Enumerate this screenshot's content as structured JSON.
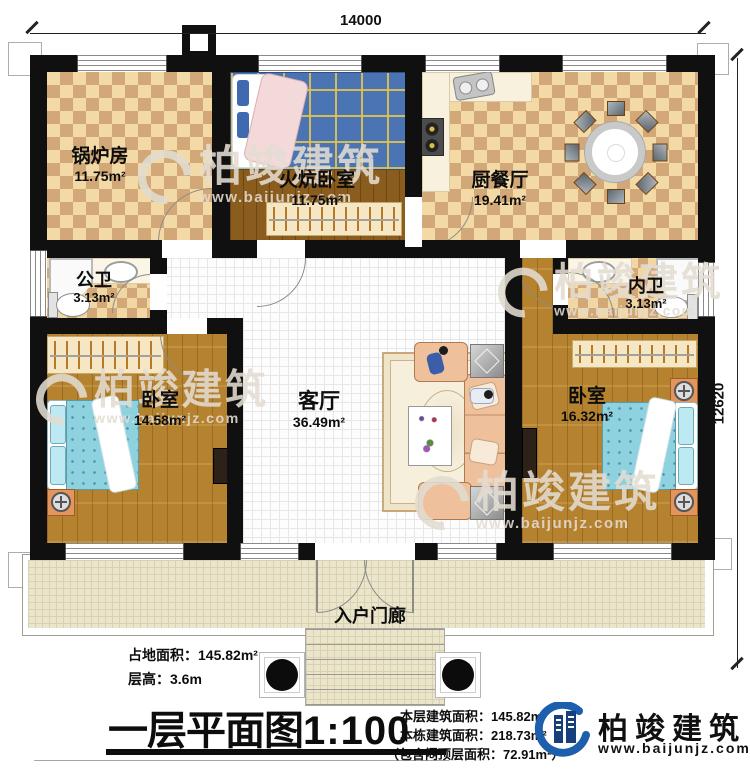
{
  "dimensions": {
    "width": "14000",
    "height": "12620"
  },
  "rooms": {
    "boiler": {
      "label": "锅炉房",
      "area": "11.75m²"
    },
    "kang_bedroom": {
      "label": "火炕卧室",
      "area": "11.75m²"
    },
    "kitchen_dining": {
      "label": "厨餐厅",
      "area": "19.41m²"
    },
    "public_bath": {
      "label": "公卫",
      "area": "3.13m²"
    },
    "inner_bath": {
      "label": "内卫",
      "area": "3.13m²"
    },
    "bedroom_left": {
      "label": "卧室",
      "area": "14.58m²"
    },
    "bedroom_right": {
      "label": "卧室",
      "area": "16.32m²"
    },
    "living_room": {
      "label": "客厅",
      "area": "36.49m²"
    },
    "entry_porch": {
      "label": "入户门廊"
    }
  },
  "info": {
    "site_area": "占地面积：145.82m²",
    "floor_height": "层高：3.6m",
    "title": "一层平面图",
    "scale": "1:100",
    "this_floor_area": "本层建筑面积：145.82m²",
    "building_area": "本栋建筑面积：218.73m²",
    "attic_note": "（包含闷顶层面积：72.91m²）"
  },
  "brand": {
    "name": "柏竣建筑",
    "website": "www.baijunjz.com"
  }
}
